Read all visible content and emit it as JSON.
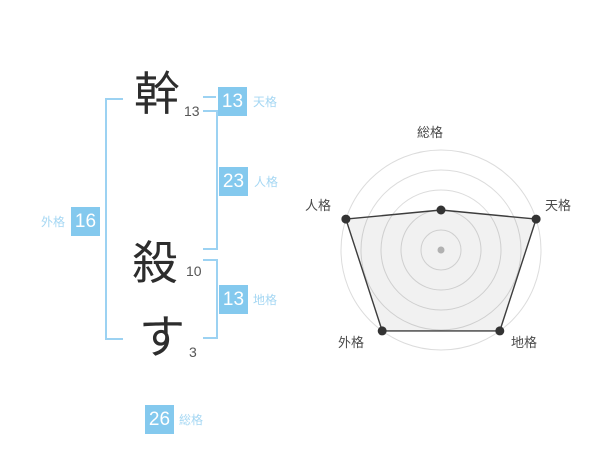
{
  "name_panel": {
    "characters": [
      {
        "char": "幹",
        "strokes": "13"
      },
      {
        "char": "殺",
        "strokes": "10"
      },
      {
        "char": "す",
        "strokes": "3"
      }
    ],
    "badges": {
      "tenkaku": {
        "value": "13",
        "label": "天格"
      },
      "jinkaku": {
        "value": "23",
        "label": "人格"
      },
      "chikaku": {
        "value": "13",
        "label": "地格"
      },
      "gaikaku": {
        "value": "16",
        "label": "外格"
      },
      "soukaku": {
        "value": "26",
        "label": "総格"
      }
    }
  },
  "colors": {
    "badge_blue": "#84c9ee",
    "label_blue": "#a5d7f3",
    "bracket_blue": "#9cd2f2",
    "polygon_stroke": "#3d3d3d",
    "polygon_fill": "rgba(0,0,0,0.055)",
    "vertex_dot": "#333333",
    "center_dot": "#bcbcbc",
    "grid_gray": "#dcdcdc",
    "chart_label": "#4a4a4a"
  },
  "chart_data": {
    "type": "radar",
    "categories": [
      "総格",
      "天格",
      "地格",
      "外格",
      "人格"
    ],
    "values": [
      2,
      5,
      5,
      5,
      5
    ],
    "max": 5,
    "levels": 5,
    "grid": true,
    "legend": false,
    "title": ""
  }
}
